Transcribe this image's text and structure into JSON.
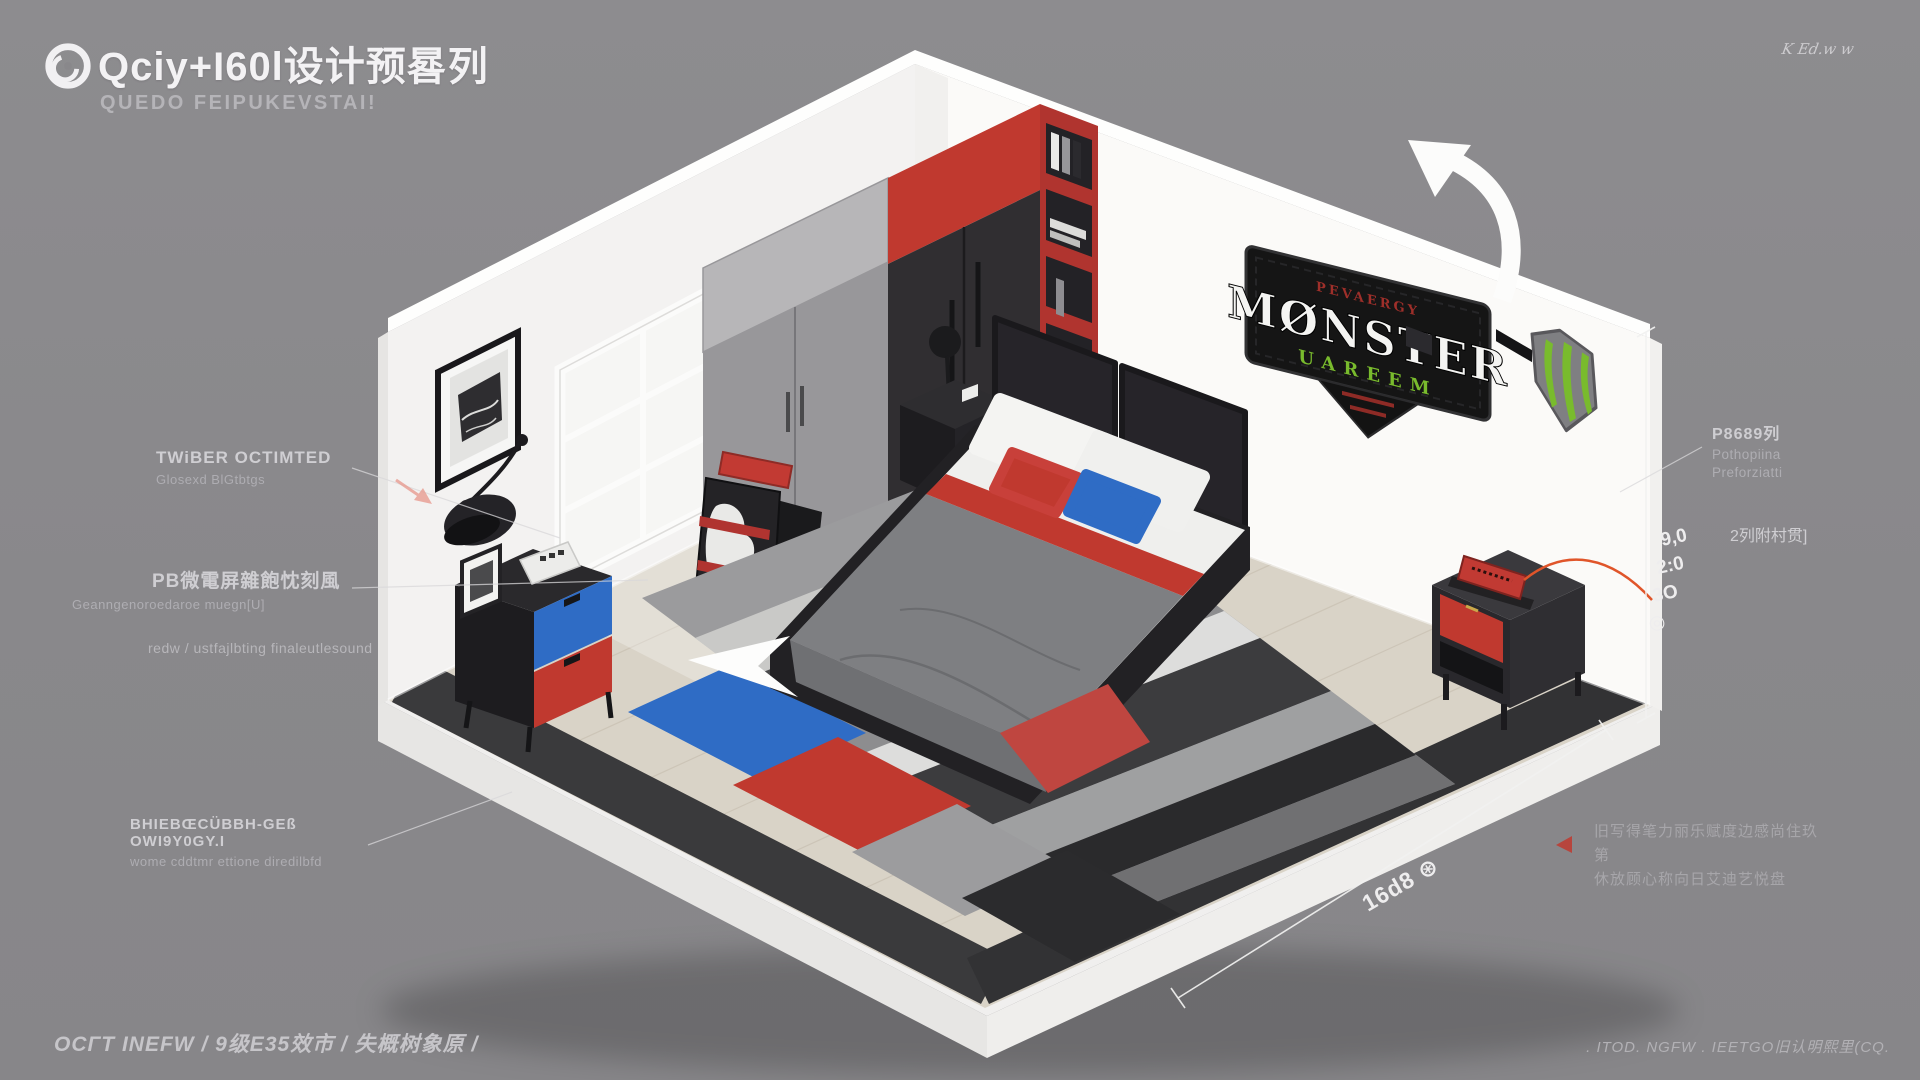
{
  "header": {
    "title": "Qciy+I60l设计预晷列",
    "subtitle": "QUEDO FEIPUKEVSTAI!"
  },
  "signature": "K Ed.w w",
  "annotations": {
    "left": [
      {
        "title": "TWiBER OCTIMTED",
        "sub": "Glosexd BlGtbtgs"
      },
      {
        "title": "PB微電屏雜飽忱刻風",
        "sub": "Geanngenoroedaroe muegn[U]",
        "sub2": "redw / ustfajlbting finaleutlesound"
      },
      {
        "title": "BHIEBŒCÜBBH-GEß OWI9Y0GY.I",
        "sub": "wome cddtmr ettione diredilbfd"
      }
    ],
    "right": {
      "title": "P8689列",
      "line2": "Pothopiina",
      "line3": "Preforziatti"
    },
    "side_note": "2列附村贯]",
    "bottom_note_line1": "旧写得笔力丽乐赋度边感尚住玖第",
    "bottom_note_line2": "休放顾心称向日艾迪艺悦盘"
  },
  "dimensions": {
    "v1": "9,0",
    "v2": "2:0",
    "v3": "3O",
    "v4": "◎",
    "bottom": "16d8 ⊛"
  },
  "room": {
    "sign": {
      "top": "PEVAERGY",
      "main": "MØNSTER",
      "sub": "UAREEM"
    },
    "colors": {
      "accent_red": "#c0392f",
      "accent_blue": "#2f6cc5",
      "monster_green": "#79bb2d",
      "wood_floor": "#d9d3c7",
      "wall_white": "#f3f2f1",
      "trim_dark": "#3a3a3c"
    }
  },
  "footer": {
    "left": "OCΓT INEFW  /  9级E35效市  /  失概树象原  /",
    "right": ". ITOD.  NGFW  .  IEETGO旧认明熙里(CQ."
  }
}
